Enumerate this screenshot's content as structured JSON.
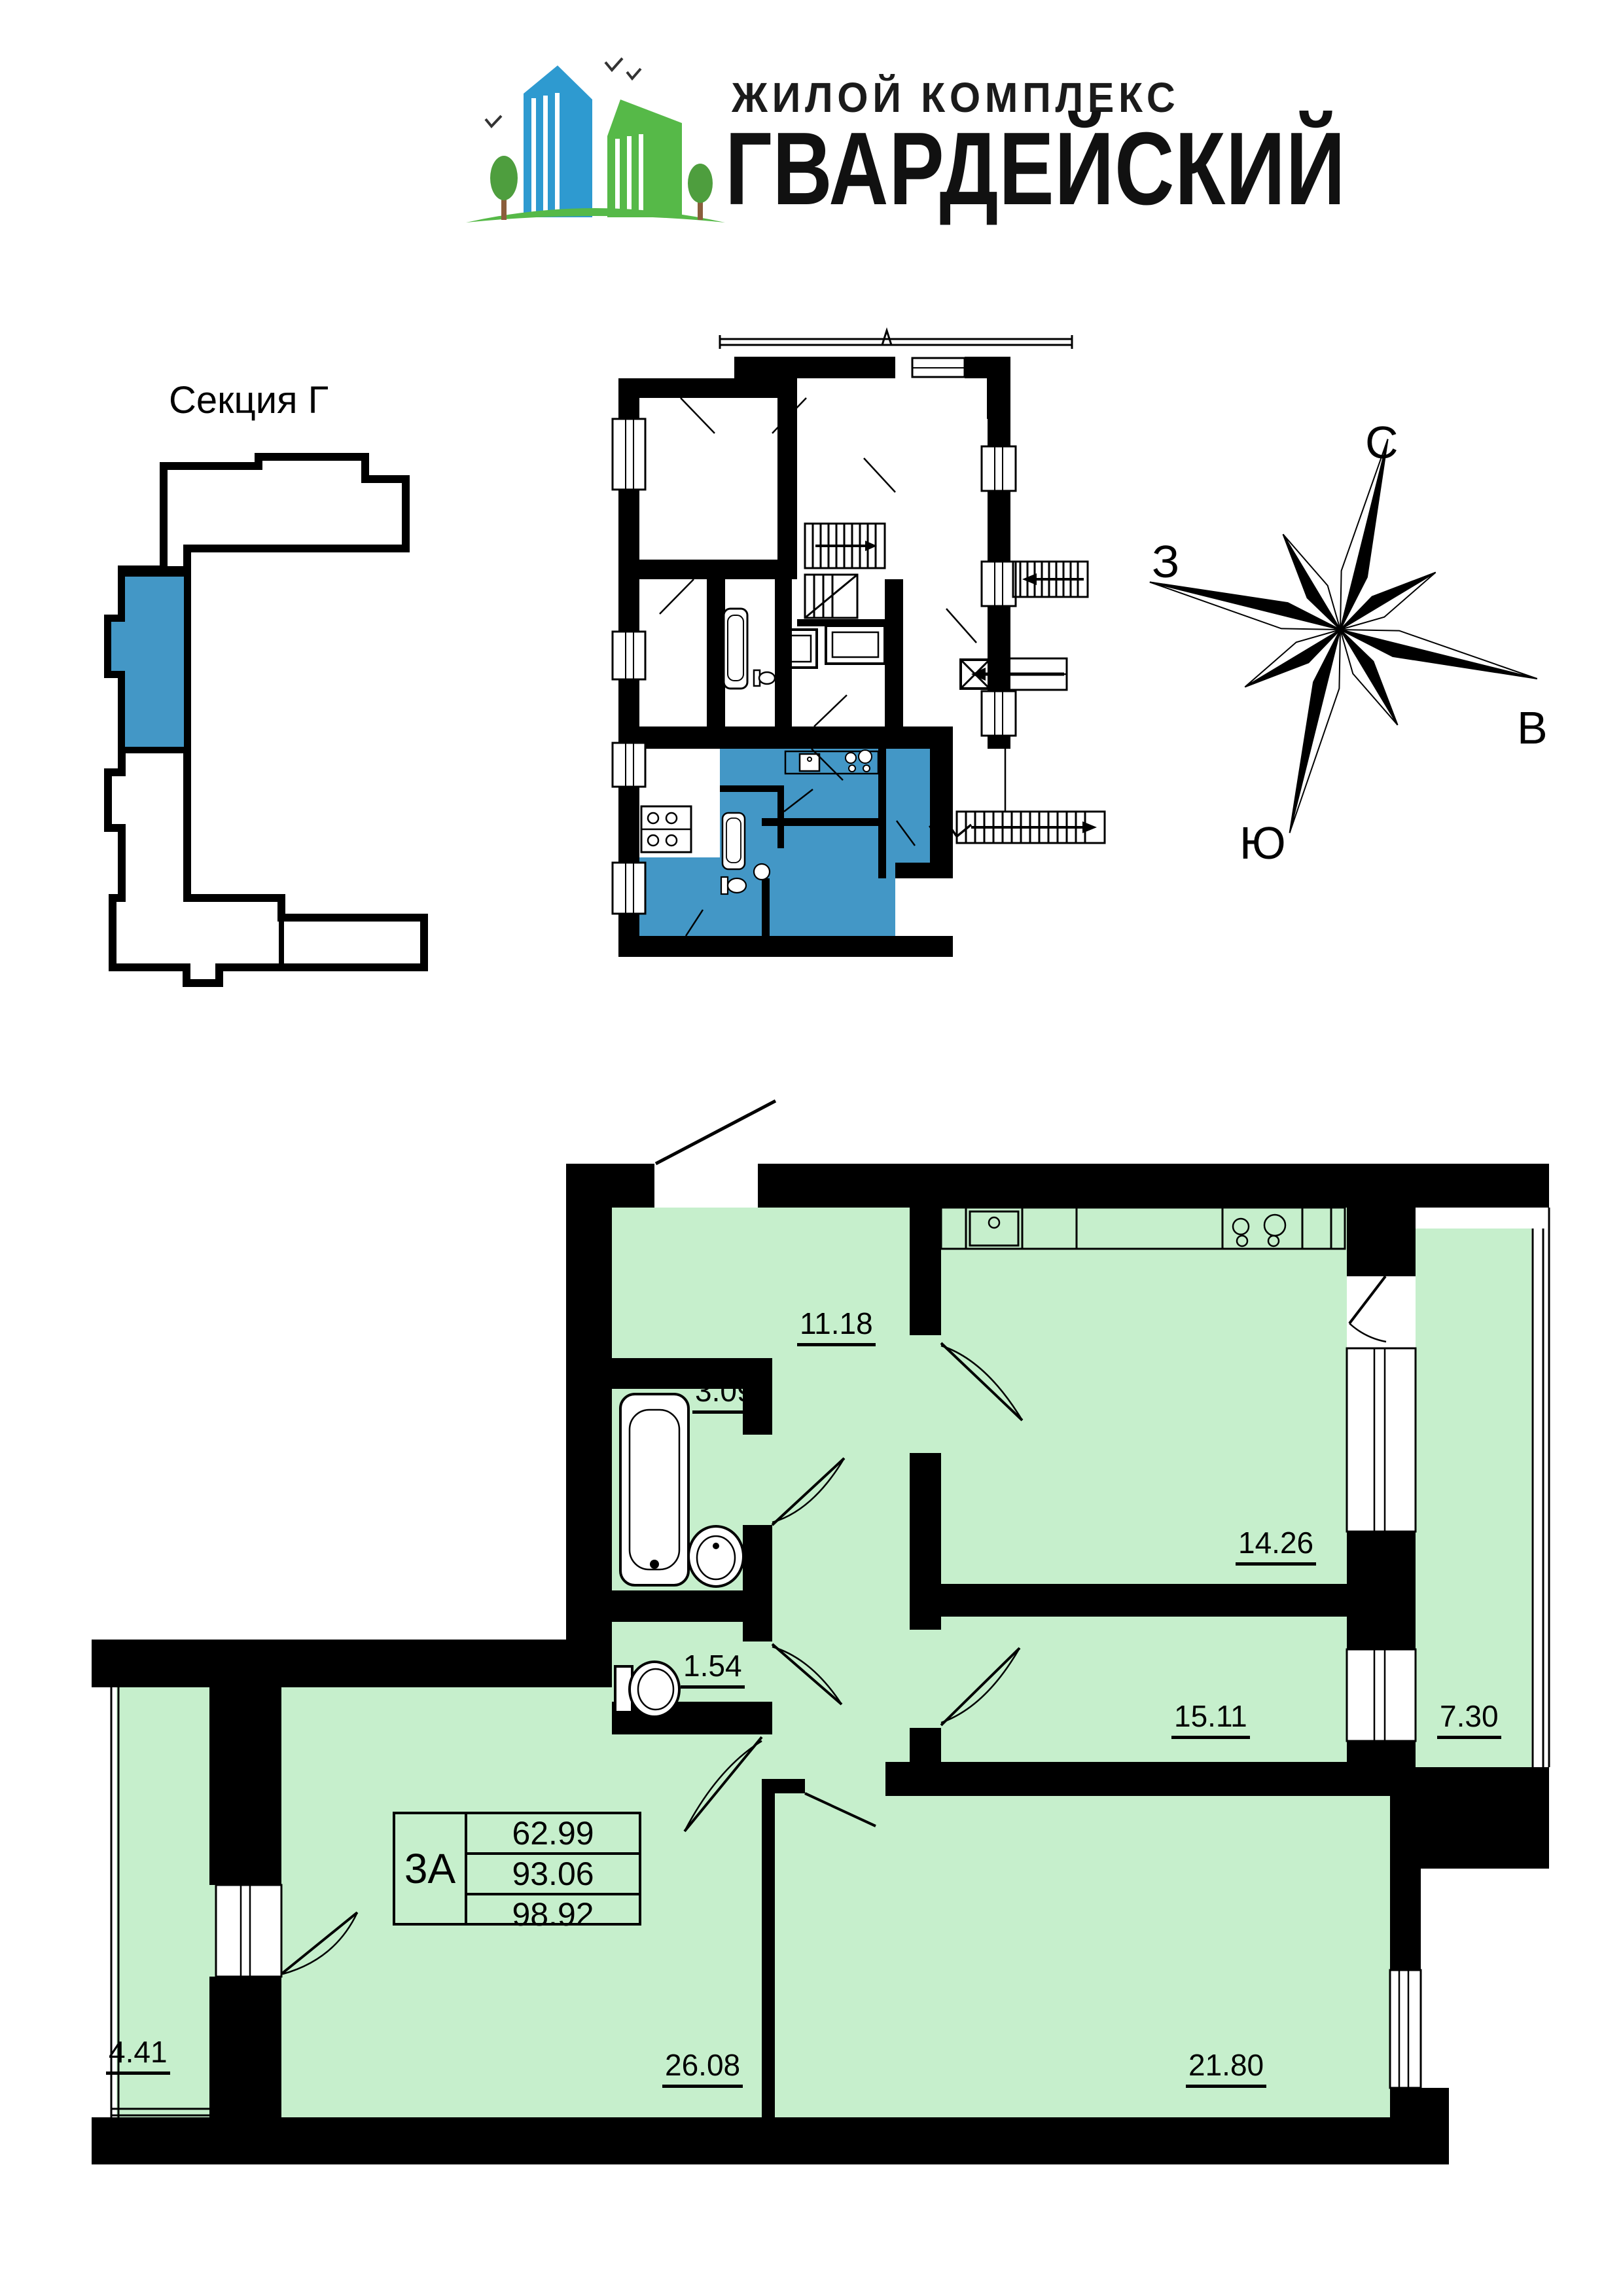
{
  "logo": {
    "subtitle": "ЖИЛОЙ КОМПЛЕКС",
    "title": "ГВАРДЕЙСКИЙ",
    "blue": "#2E9AD0",
    "green": "#56B948"
  },
  "section_map": {
    "label": "Секция Г",
    "highlight_color": "#4397C6"
  },
  "compass": {
    "north": "С",
    "south": "Ю",
    "west": "З",
    "east": "В"
  },
  "plan": {
    "room_color": "#C6EFCC",
    "highlight_color": "#4397C6",
    "labels": {
      "hall": "11.18",
      "bath": "3.09",
      "wc": "1.54",
      "kitchen": "14.26",
      "bedroom1": "15.11",
      "balcony_right": "7.30",
      "living": "26.08",
      "bedroom2": "21.80",
      "balcony_left": "4.41"
    }
  },
  "apartment": {
    "type": "3А",
    "rows": [
      "62.99",
      "93.06",
      "98.92"
    ]
  }
}
